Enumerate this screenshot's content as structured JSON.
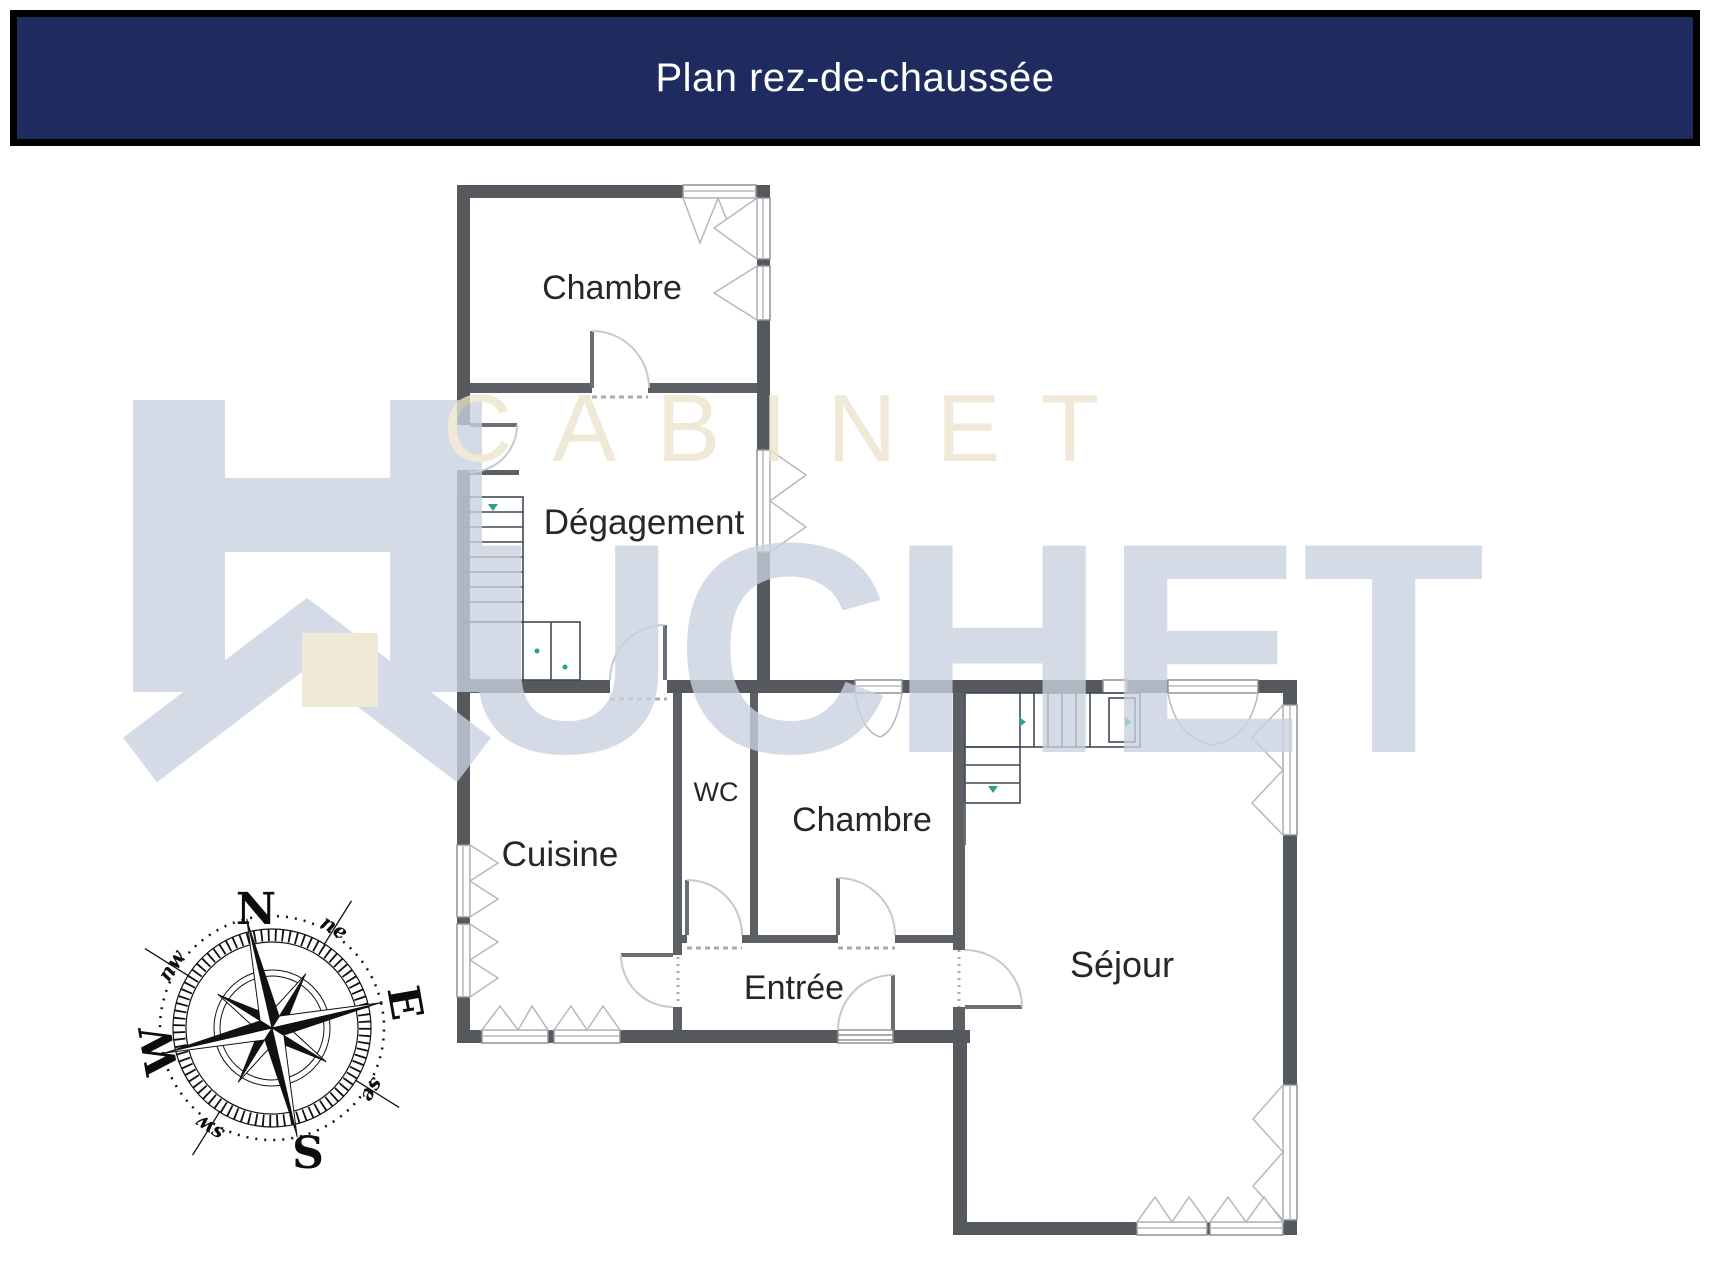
{
  "header": {
    "title": "Plan rez-de-chaussée"
  },
  "rooms": {
    "chambre_nord": "Chambre",
    "degagement": "Dégagement",
    "cuisine": "Cuisine",
    "wc": "WC",
    "chambre_sud": "Chambre",
    "entree": "Entrée",
    "sejour": "Séjour"
  },
  "watermark": {
    "cabinet": "CABINET",
    "huchet_rest": "UCHET",
    "full_name": "CABINET HUCHET"
  },
  "compass": {
    "north": "N",
    "east": "E",
    "south": "S",
    "west": "W",
    "ne": "ne",
    "se": "se",
    "sw": "sw",
    "nw": "nw"
  },
  "colors": {
    "banner_navy": "#1e2b5f",
    "wall_gray": "#55595d",
    "watermark_blue": "#c9d2e0",
    "watermark_beige": "#ece3cc",
    "stair_mark_teal": "#2fa08c"
  }
}
